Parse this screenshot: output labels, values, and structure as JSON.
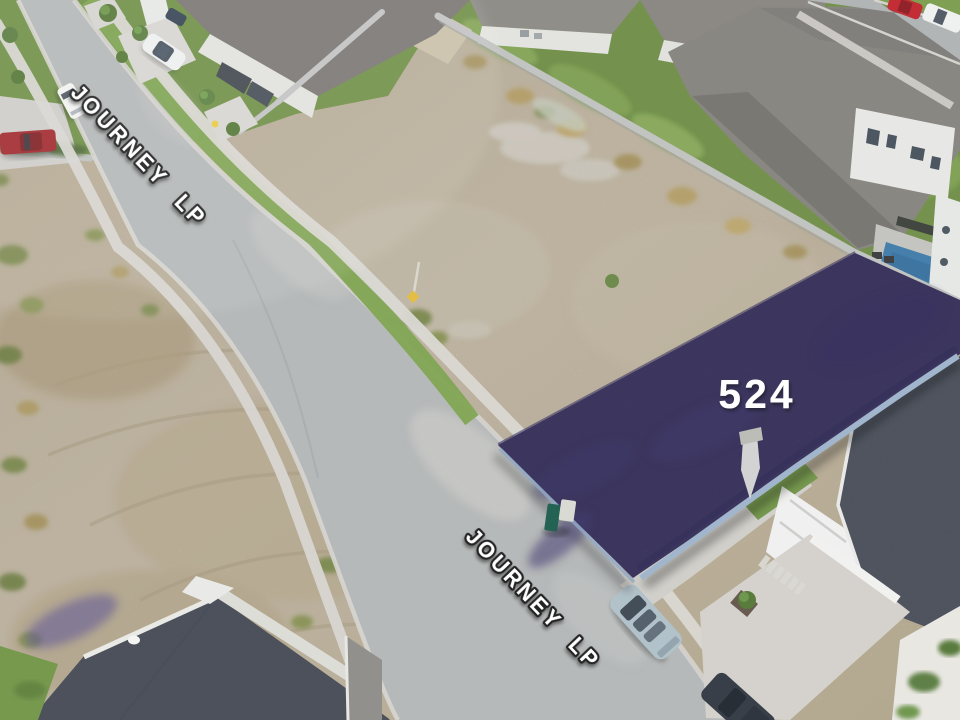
{
  "photo": {
    "kind": "aerial-drone-listing-photo",
    "street_labels": {
      "upper": "JOURNEY LP",
      "lower": "JOURNEY LP"
    },
    "lot": {
      "number": "524"
    },
    "colors": {
      "lot_fill": "#48407f",
      "lot_dark_mottle": "#332d60",
      "lot_edge_highlight": "#9cb2ca",
      "label_fill": "#ffffff",
      "label_outline": "#161616",
      "sand": "#d7cab1",
      "road": "#b9bcbc",
      "sidewalk": "#d8d6d1",
      "lawn": "#7ba04c",
      "roof_gray": "#8f8c87",
      "roof_dark_gray": "#6b6763",
      "roof_navy": "#2d333f",
      "concrete_wall": "#c6c9c6",
      "pool_water": "#3e7dad",
      "red_truck": "#9e2227",
      "silver_suv": "#aebfc7"
    }
  }
}
